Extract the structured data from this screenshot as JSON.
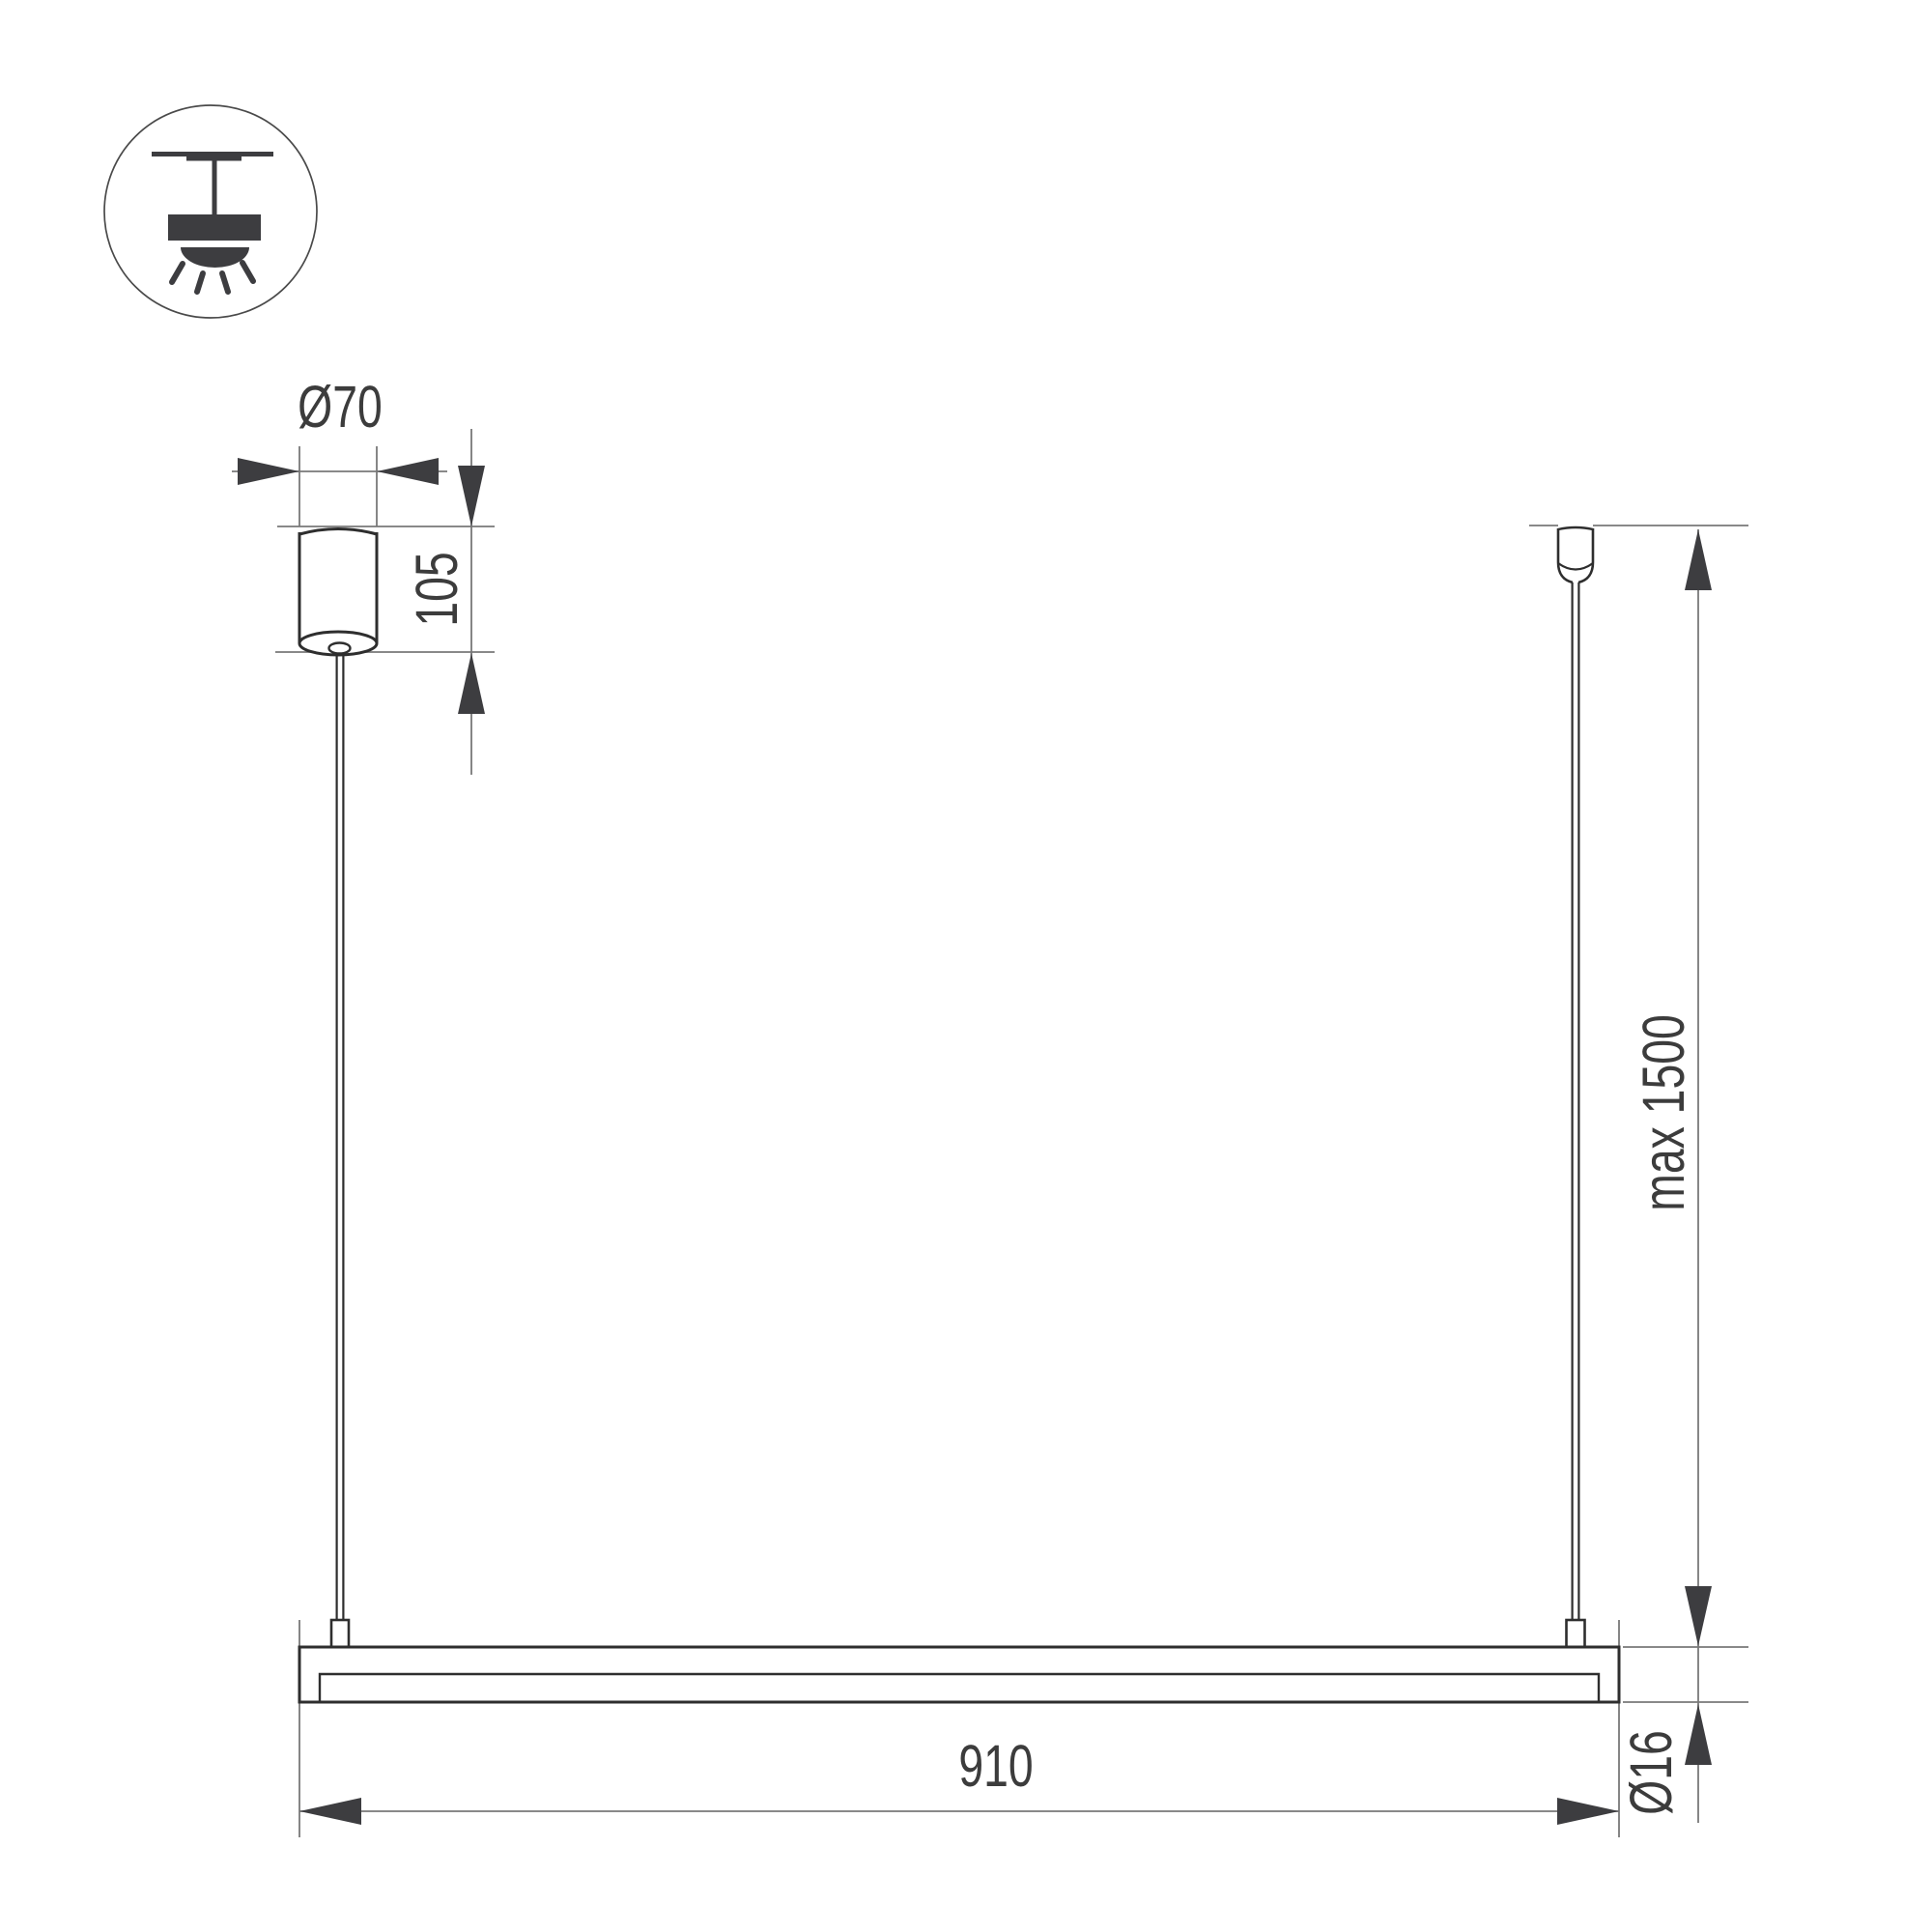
{
  "drawing_title": "pendant-linear-luminaire-dimension-drawing",
  "colors": {
    "background": "#ffffff",
    "product_ink": "#2e2e2e",
    "icon_fill": "#3d3d40",
    "dimension_line": "#787878",
    "label_text": "#3c3c3c"
  },
  "icon": {
    "name": "pendant-ceiling-light-icon"
  },
  "dimensions": {
    "canopy_diameter": "Ø70",
    "canopy_height": "105",
    "max_suspension": "max 1500",
    "fixture_length": "910",
    "tube_diameter": "Ø16"
  }
}
